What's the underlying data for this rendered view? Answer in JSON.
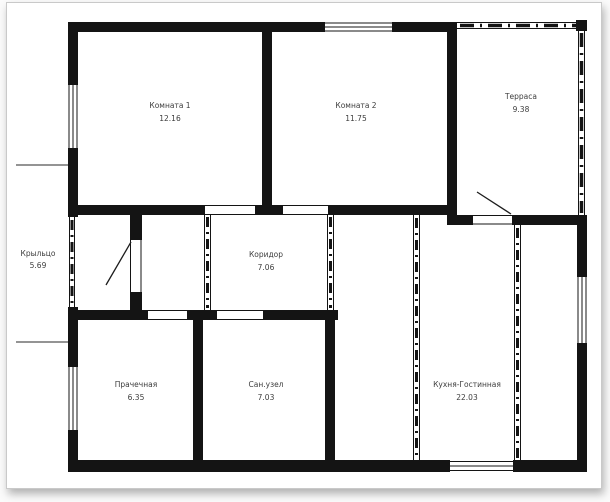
{
  "document": {
    "type": "floor-plan",
    "language": "ru",
    "page_background": "#ffffff",
    "page_border_color": "#c9c9c9",
    "wall_color": "#141414",
    "label_color": "#3d3d3d"
  },
  "plan": {
    "area_unit_implied": "m2",
    "rooms": [
      {
        "name": "Комната 1",
        "area": "12.16"
      },
      {
        "name": "Комната 2",
        "area": "11.75"
      },
      {
        "name": "Терраса",
        "area": "9.38"
      },
      {
        "name": "Крыльцо",
        "area": "5.69"
      },
      {
        "name": "Коридор",
        "area": "7.06"
      },
      {
        "name": "Прачечная",
        "area": "6.35"
      },
      {
        "name": "Сан.узел",
        "area": "7.03"
      },
      {
        "name": "Кухня-Гостинная",
        "area": "22.03"
      }
    ]
  }
}
